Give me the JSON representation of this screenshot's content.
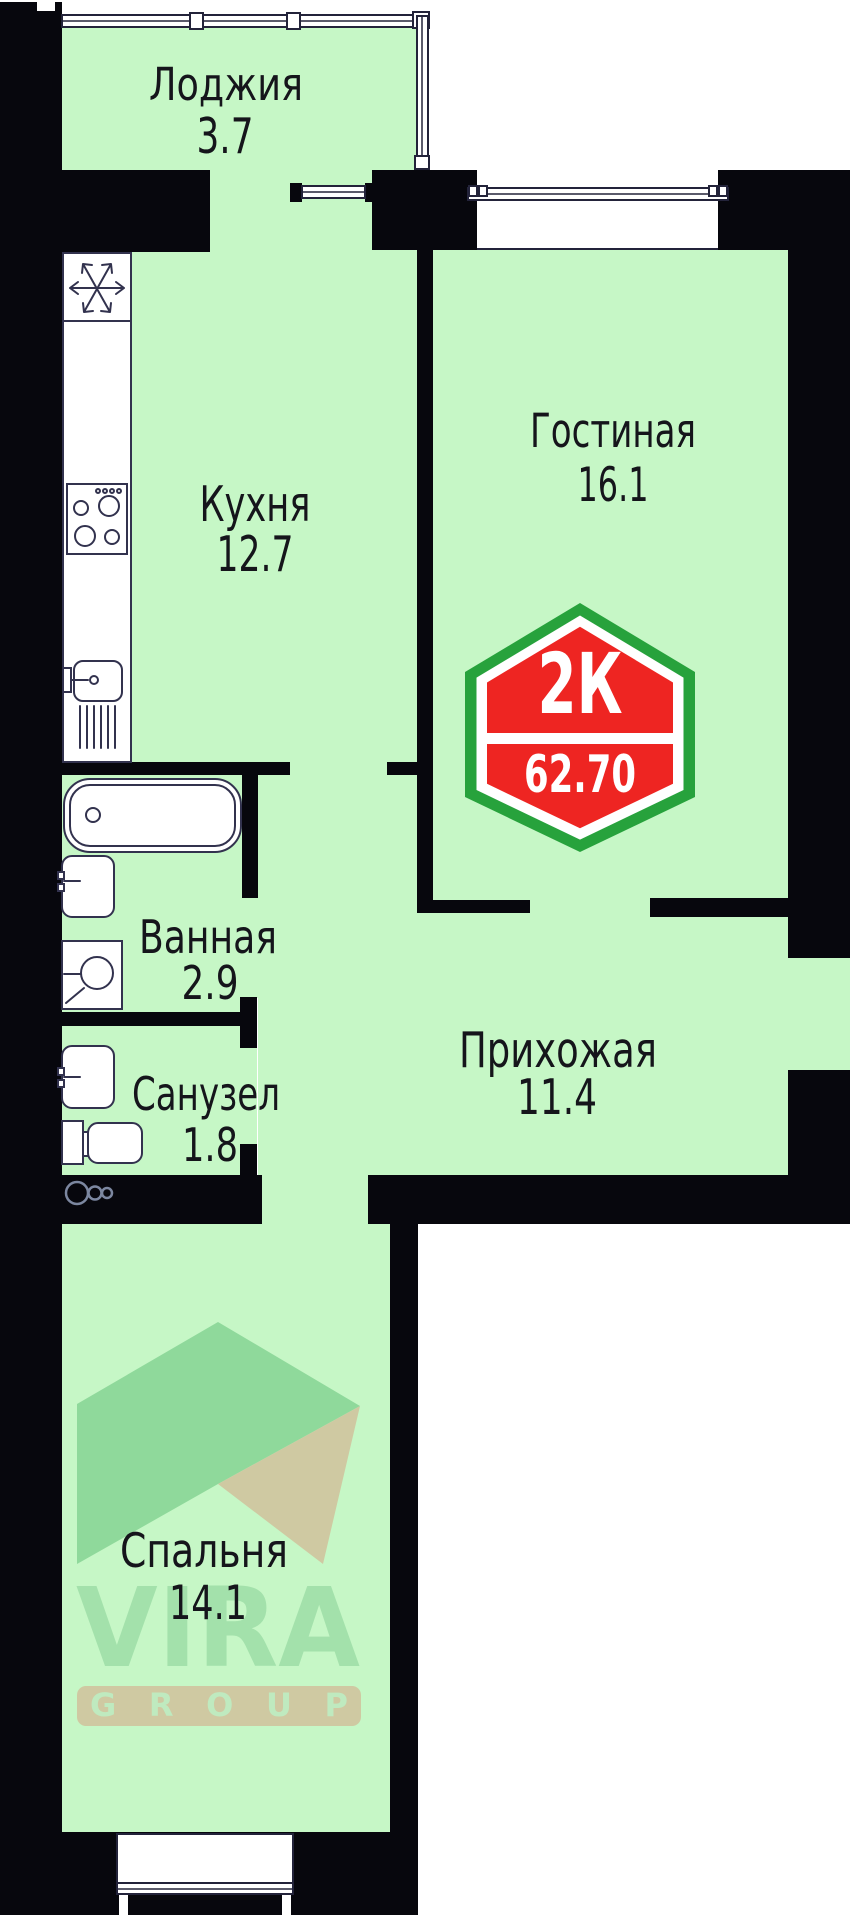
{
  "colors": {
    "room_fill": "#c6f7c6",
    "wall": "#07070d",
    "label": "#15151b",
    "niche_line": "#23233a"
  },
  "rooms": [
    {
      "name": "Лоджия",
      "area": "3.7"
    },
    {
      "name": "Кухня",
      "area": "12.7"
    },
    {
      "name": "Гостиная",
      "area": "16.1"
    },
    {
      "name": "Ванная",
      "area": "2.9"
    },
    {
      "name": "Санузел",
      "area": "1.8"
    },
    {
      "name": "Прихожая",
      "area": "11.4"
    },
    {
      "name": "Спальня",
      "area": "14.1"
    }
  ],
  "badge": {
    "type_label": "2К",
    "area_value": "62.70",
    "red": "#ee2522",
    "green": "#27a23c"
  },
  "watermark": {
    "brand": "VIRA",
    "group": "GROUP",
    "green": "#8fd99b",
    "beige": "#cfc9a2",
    "brand_color": "#a3e1ab",
    "group_text_color": "#bfeabf"
  },
  "fixtures": {
    "fridge": "snowflake-icon",
    "stove": "burners-icon",
    "kitchen_sink": "sink-drainer-icon",
    "bathtub": "bathtub-icon",
    "washbasin": "washbasin-icon",
    "washing_machine": "washing-machine-icon",
    "wc_sink": "washbasin-icon",
    "toilet": "toilet-icon",
    "vent": "vent-circles-icon"
  }
}
